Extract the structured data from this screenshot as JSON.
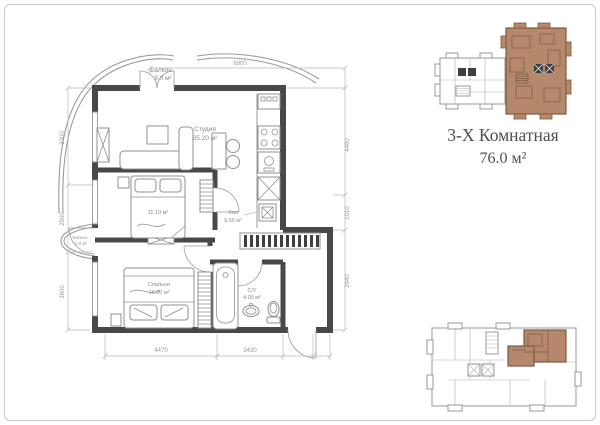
{
  "summary": {
    "type": "3-Х Комнатная",
    "area": "76.0 м²"
  },
  "plan": {
    "rooms": {
      "studio": {
        "name": "Студия",
        "area": "25.20 м²"
      },
      "bedroom1": {
        "area": "11.10 м²"
      },
      "bedroom2": {
        "name": "Спальня",
        "area": "16.00 м²"
      },
      "bathroom": {
        "name": "С/У",
        "area": "4.00 м²"
      },
      "hall": {
        "name": "Хол",
        "area": "9.55 м²"
      },
      "balcony_top": {
        "name": "Балкон",
        "area": "9.0 м²"
      },
      "balcony_left": {
        "name": "Балкон",
        "area": "2.0 м²"
      }
    },
    "dimensions": {
      "top": "6900",
      "bottom": [
        "4470",
        "2430"
      ],
      "left": [
        "3300",
        "2500",
        "3600"
      ],
      "right": [
        "4480",
        "1010",
        "2940"
      ]
    }
  },
  "colors": {
    "highlight": "#b5886b",
    "highlight_outline": "#7a5a42",
    "wall": "#484848",
    "furniture_line": "#909090",
    "dimension_text": "#9a9a9a",
    "title_text": "#4f4f4f"
  }
}
